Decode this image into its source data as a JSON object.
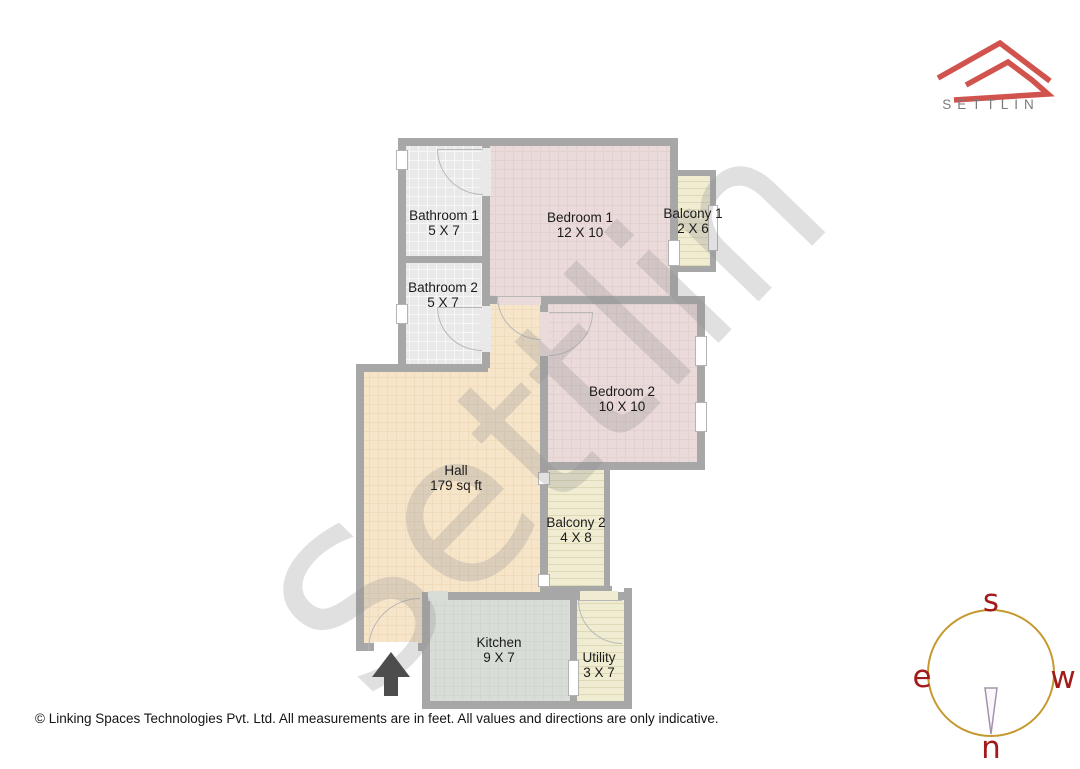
{
  "brand": {
    "logo_text": "SETTLIN",
    "logo_red": "#d1534e",
    "logo_text_color": "#7a7a7a"
  },
  "watermark_text": "Settlin",
  "floor_plan": {
    "wall_color": "#a7a7a7",
    "fills": {
      "bathroom": "#e9e9e9",
      "bedroom": "#ebdada",
      "hall": "#f7e5ca",
      "kitchen": "#d8ddd7",
      "balcony_utility": "#f0ecd2"
    },
    "entrance_arrow_icon": "arrow-up",
    "rooms": [
      {
        "name": "Bathroom 1",
        "dims": "5 X 7"
      },
      {
        "name": "Bedroom 1",
        "dims": "12 X 10"
      },
      {
        "name": "Balcony 1",
        "dims": "2 X 6"
      },
      {
        "name": "Bathroom 2",
        "dims": "5 X 7"
      },
      {
        "name": "Bedroom 2",
        "dims": "10 X 10"
      },
      {
        "name": "Hall",
        "dims": "179 sq ft"
      },
      {
        "name": "Balcony 2",
        "dims": "4 X 8"
      },
      {
        "name": "Kitchen",
        "dims": "9 X 7"
      },
      {
        "name": "Utility",
        "dims": "3 X 7"
      }
    ]
  },
  "compass": {
    "top": "s",
    "bottom": "n",
    "left": "e",
    "right": "w",
    "ring_color": "#c5992e",
    "letter_color": "#a31a1a",
    "needle_icon": "compass-needle"
  },
  "footer_note": "© Linking Spaces Technologies Pvt. Ltd. All measurements are in feet. All values and directions are only indicative."
}
